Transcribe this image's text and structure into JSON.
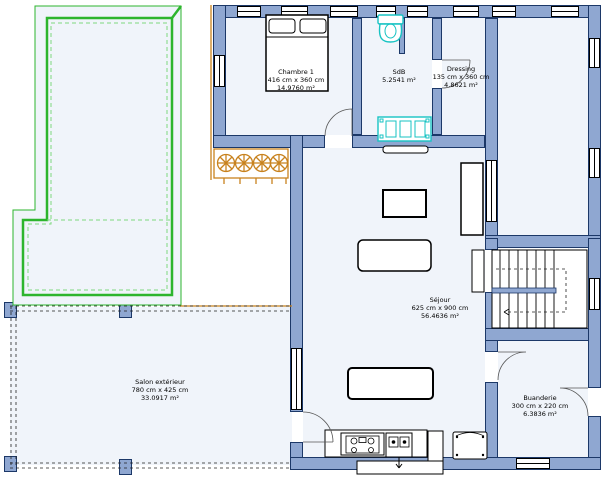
{
  "rooms": [
    {
      "name": "Chambre 1",
      "dimensions": "416 cm x 360 cm",
      "area": "14.9760 m²"
    },
    {
      "name": "SdB",
      "dimensions": "",
      "area": "5.2541 m²"
    },
    {
      "name": "Dressing",
      "dimensions": "135 cm x 360 cm",
      "area": "4.8621 m²"
    },
    {
      "name": "Séjour",
      "dimensions": "625 cm x 900 cm",
      "area": "56.4636 m²"
    },
    {
      "name": "Salon extérieur",
      "dimensions": "780 cm x 425 cm",
      "area": "33.0917 m²"
    },
    {
      "name": "Buanderie",
      "dimensions": "300 cm x 220 cm",
      "area": "6.3836 m²"
    }
  ],
  "colors": {
    "wall": "#8fa7d1",
    "wall-border": "#1c3868",
    "room": "#f0f4fa",
    "pool": "#2db52d",
    "pool-dash": "#7ed87e",
    "landscape": "#c8821e",
    "plumb": "#17c3c3"
  },
  "icons": [
    "double-bed-icon",
    "toilet-icon",
    "double-washbasin-icon",
    "sofa-icon",
    "coffee-table-icon",
    "dining-table-icon",
    "sideboard-icon",
    "cooktop-icon",
    "kitchen-sink-icon",
    "staircase-icon",
    "swimming-pool-icon",
    "plant-row-icon",
    "door-arc-icon"
  ]
}
